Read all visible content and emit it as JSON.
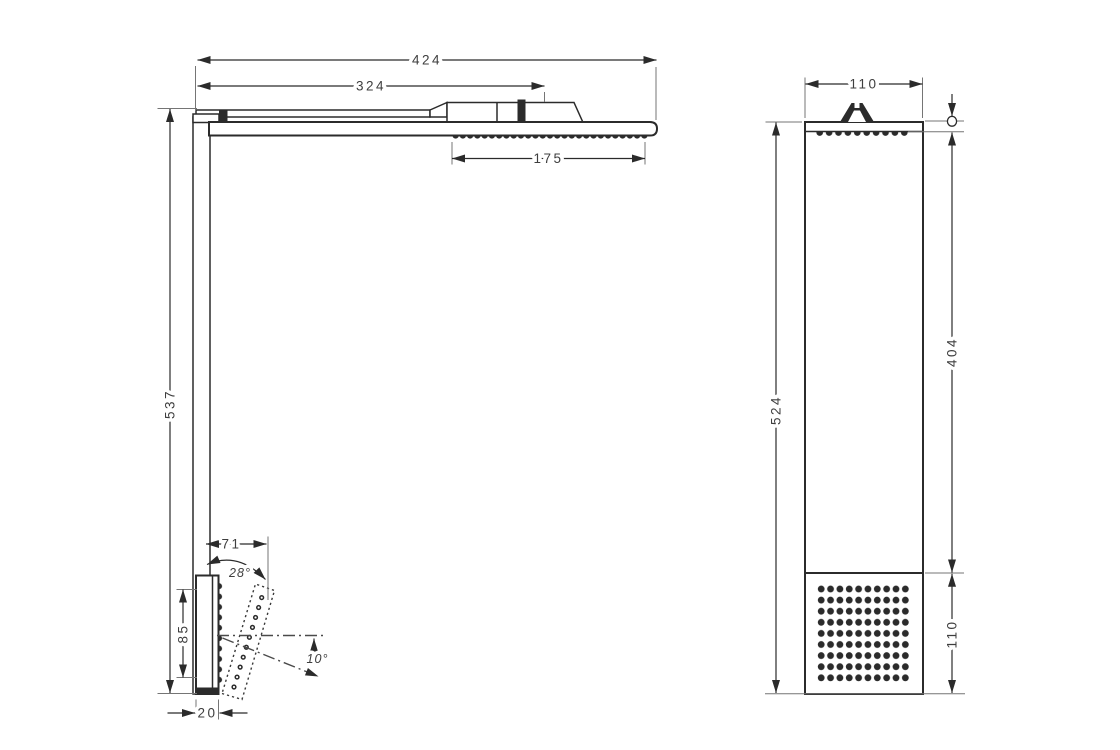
{
  "colors": {
    "background": "#ffffff",
    "line": "#2b2b2b",
    "text": "#3e3e3e"
  },
  "side_view": {
    "dims": {
      "total_width": "424",
      "upper_width": "324",
      "head_spray_width": "175",
      "total_height": "537",
      "body_spray_reach": "71",
      "body_spray_tilt_angle": "28°",
      "body_spray_height": "85",
      "body_spray_down_angle": "10°",
      "body_spray_depth": "20"
    }
  },
  "front_view": {
    "dims": {
      "width": "110",
      "total_height": "524",
      "upper_height": "404",
      "lower_spray_height": "110"
    }
  }
}
